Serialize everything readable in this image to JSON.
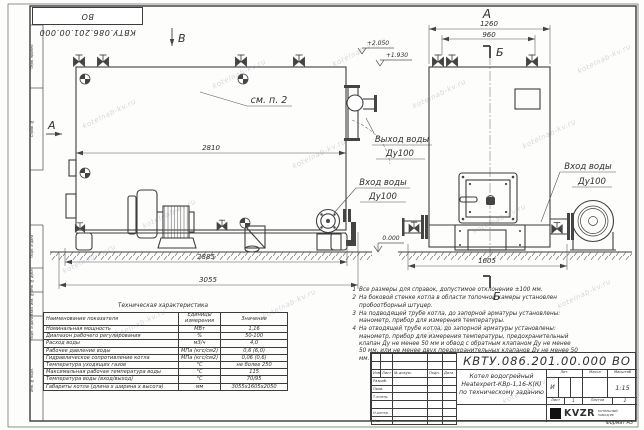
{
  "watermark": "kotelnab-kv.ru",
  "frame": {
    "stamp_top": "КВТУ.086.201.00.000  ВО",
    "margin_labels": [
      "Перв. примен.",
      "Справ. №",
      "Подп. и дата",
      "Инв. № дубл.",
      "Взам. инв. №",
      "Подп. и дата",
      "Инв. № подл."
    ],
    "format_note": "Формат  А3"
  },
  "side_view": {
    "label_b": "В",
    "label_a": "А",
    "see_ref": "см. п. 2",
    "dim_2810": "2810",
    "dim_2885": "2885",
    "dim_3055": "3055",
    "elev_2050": "+2.050",
    "elev_1930": "+1.930",
    "elev_0": "0.000",
    "outlet_line1": "Выход воды",
    "outlet_line2": "Ду100",
    "inlet_line1": "Вход воды",
    "inlet_line2": "Ду100"
  },
  "front_view": {
    "label": "А",
    "section": "Б",
    "dim_1260": "1260",
    "dim_960": "960",
    "dim_1605": "1605",
    "inlet_line1": "Вход воды",
    "inlet_line2": "Ду100"
  },
  "notes": {
    "items": [
      {
        "num": "1",
        "text": "Все размеры для справок, допустимое отклонение ±100 мм."
      },
      {
        "num": "2",
        "text": "На боковой стенке котла в области топочной камеры установлен пробоотборный штуцер."
      },
      {
        "num": "3",
        "text": "На подводящей трубе котла, до запорной арматуры установлены: манометр, прибор для измерения температуры."
      },
      {
        "num": "4",
        "text": "На отводящей трубе котла, до запорной арматуры установлены: манометр, прибор для измерения температуры, предохранительный клапан Ду не менее 50 мм и обвод с обратным клапаном Ду не менее 50 мм, или не менее двух предохранительных клапанов Ду не менее 50 мм."
      }
    ]
  },
  "tech_table": {
    "title": "Техническая характеристика",
    "headers": [
      "Наименование показателя",
      "Единицы измерения",
      "Значение"
    ],
    "rows": [
      [
        "Номинальная мощность",
        "МВт",
        "1,16"
      ],
      [
        "Диапазон рабочего регулирования",
        "%",
        "50-100"
      ],
      [
        "Расход воды",
        "м3/ч",
        "4,0"
      ],
      [
        "Рабочее давление воды",
        "МПа (кгс/см2)",
        "0,6 (6,0)"
      ],
      [
        "Гидравлическое сопротивление котла",
        "МПа (кгс/см2)",
        "0,06 (0,6)"
      ],
      [
        "Температура уходящих газов",
        "°С",
        "не более 250"
      ],
      [
        "Максимальная рабочая температура воды",
        "°С",
        "115"
      ],
      [
        "Температура воды (вход/выход)",
        "°С",
        "70/95"
      ],
      [
        "Габариты котла (длина х ширина х высота)",
        "мм",
        "3055х1605х2050"
      ]
    ]
  },
  "title_block": {
    "doc_number": "КВТУ.086.201.00.000  ВО",
    "name_line1": "Котел водогрейный",
    "name_line2": "Heatexpert-КВр-1,16-К(К)",
    "name_line3": "по техническому заданию",
    "col_lit": "Лит.",
    "col_mass": "Масса",
    "col_scale": "Масштаб",
    "lit_value": "И",
    "scale_value": "1:15",
    "sheet_label": "Лист",
    "sheet_value": "1",
    "sheets_label": "Листов",
    "sheets_value": "2",
    "sig_headers": [
      "Изм",
      "Лист",
      "№ докум.",
      "Подп.",
      "Дата"
    ],
    "sig_rows": [
      "Разраб.",
      "Пров.",
      "Т.контр.",
      "",
      "Н.контр.",
      "Утв."
    ],
    "logo_text": "KVZR",
    "logo_sub1": "КОТЕЛЬНЫЙ",
    "logo_sub2": "ЗАВОД РФ"
  }
}
